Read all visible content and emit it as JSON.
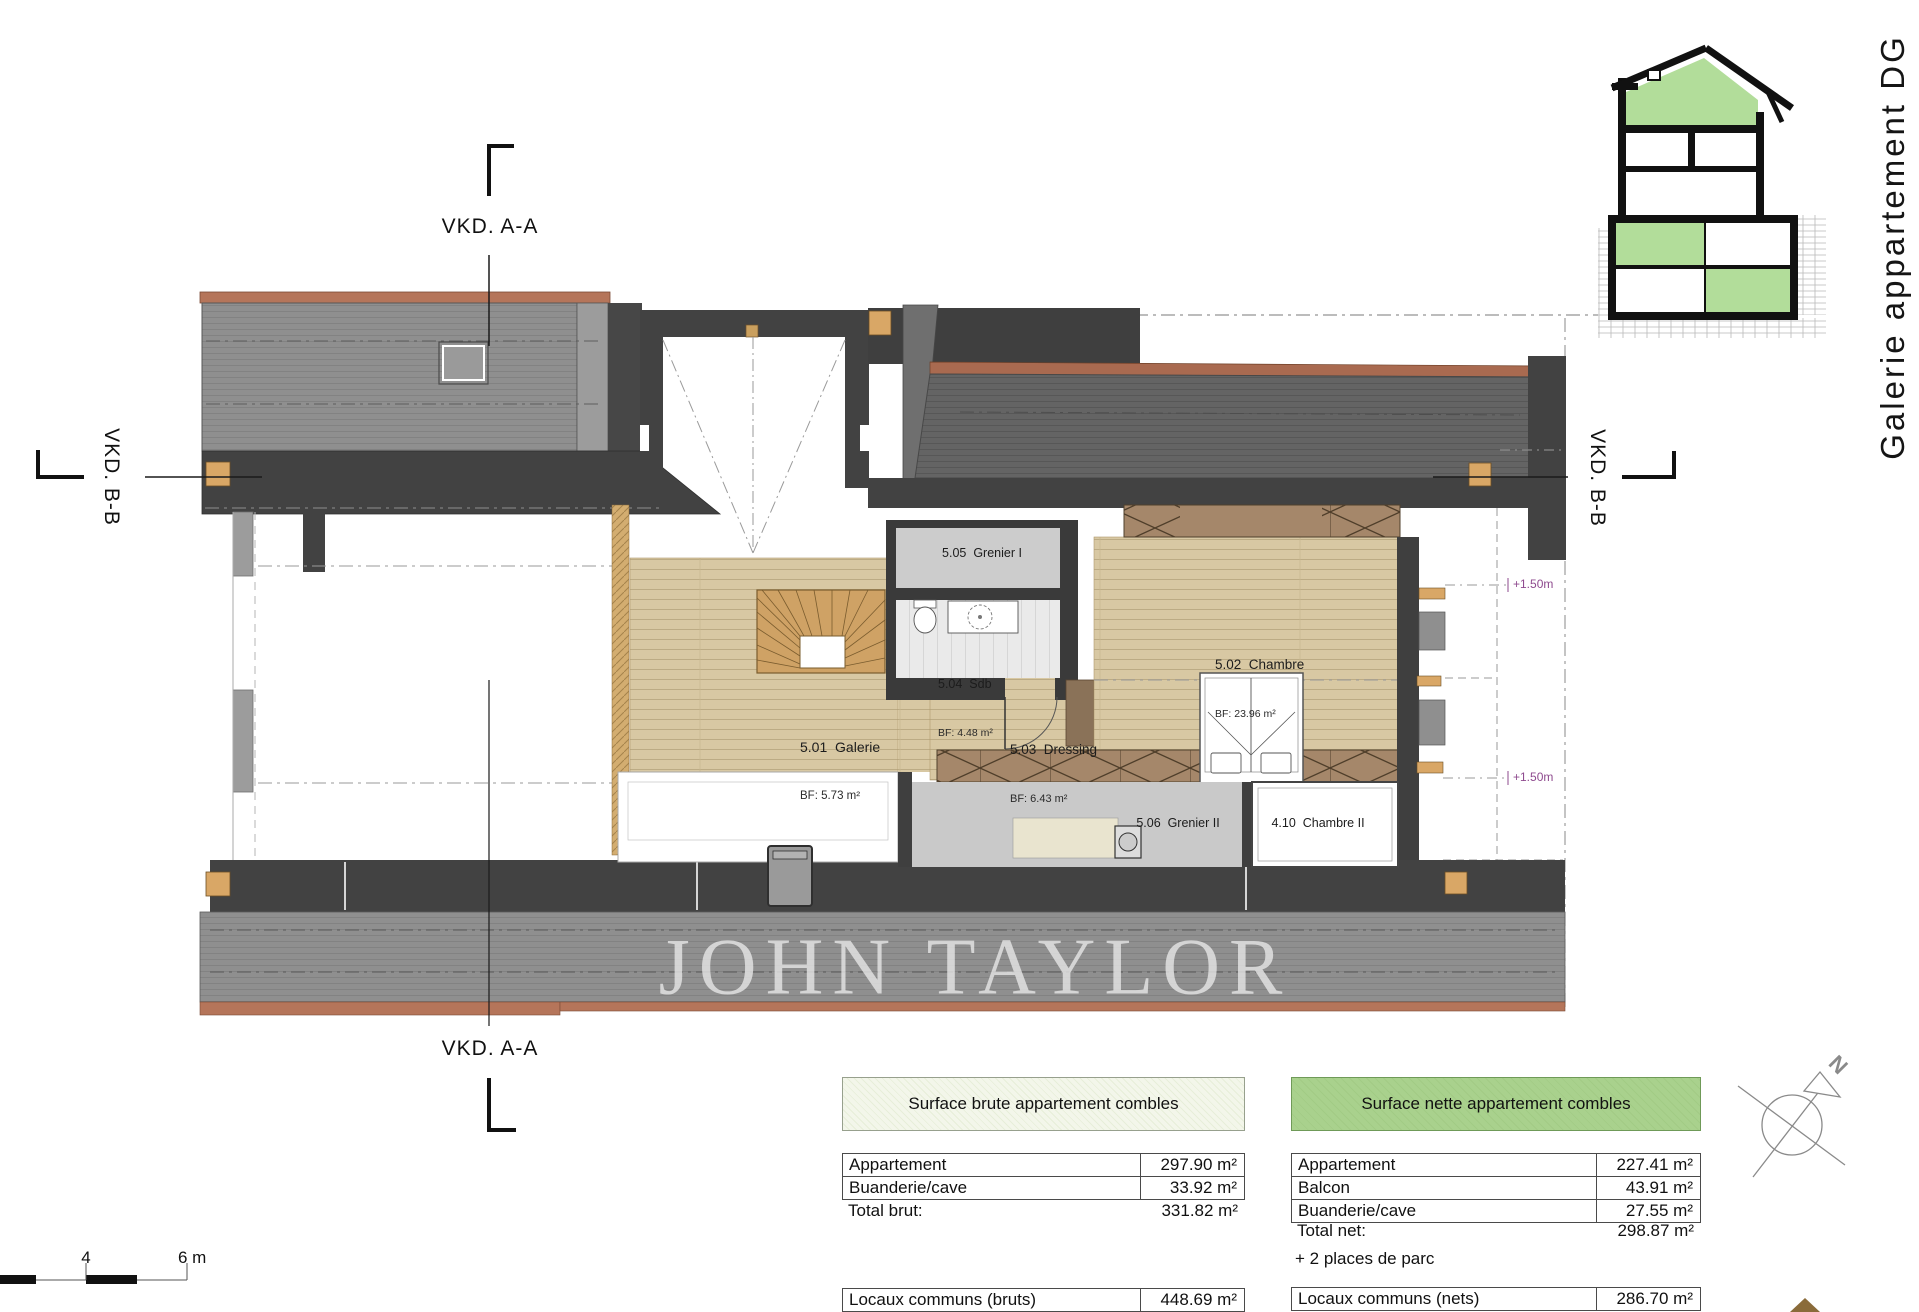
{
  "title": "Galerie appartement DG",
  "watermark": "JOHN TAYLOR",
  "sections": {
    "aa_top": "VKD. A-A",
    "aa_bottom": "VKD. A-A",
    "bb_left": "VKD. B-B",
    "bb_right": "VKD. B-B"
  },
  "levels": {
    "upper": "+1.50m",
    "lower": "+1.50m"
  },
  "north_label": "N",
  "scale_bar": {
    "tick_mid": "4",
    "tick_end": "6 m"
  },
  "rooms": {
    "grenier1": {
      "label": "5.05  Grenier I",
      "area": ""
    },
    "sdb": {
      "label": "5.04  Sdb",
      "area": "BF: 4.48 m²"
    },
    "chambre": {
      "label": "5.02  Chambre",
      "area": "BF: 23.96 m²"
    },
    "galerie": {
      "label": "5.01  Galerie",
      "area": "BF: 5.73 m²"
    },
    "dressing": {
      "label": "5.03  Dressing",
      "area": "BF: 6.43 m²"
    },
    "grenier2": {
      "label": "5.06  Grenier II",
      "area": ""
    },
    "chambre2": {
      "label": "4.10  Chambre II",
      "area": ""
    }
  },
  "tables": {
    "brute": {
      "header": "Surface brute appartement combles",
      "rows": [
        {
          "label": "Appartement",
          "value": "297.90 m²"
        },
        {
          "label": "Buanderie/cave",
          "value": "33.92 m²"
        }
      ],
      "total_label": "Total brut:",
      "total_value": "331.82 m²",
      "commons_label": "Locaux communs (bruts)",
      "commons_value": "448.69 m²"
    },
    "nette": {
      "header": "Surface nette appartement combles",
      "rows": [
        {
          "label": "Appartement",
          "value": "227.41 m²"
        },
        {
          "label": "Balcon",
          "value": "43.91 m²"
        },
        {
          "label": "Buanderie/cave",
          "value": "27.55 m²"
        }
      ],
      "total_label": "Total net:",
      "total_value": "298.87 m²",
      "note": "+ 2 places de parc",
      "commons_label": "Locaux communs (nets)",
      "commons_value": "286.70 m²"
    }
  },
  "colors": {
    "header_green": "#a9d18d",
    "header_light_green": "#eff4e6",
    "annotation_purple": "#8e4a8e",
    "wood_floor": "#d8c8a3",
    "roof_gray_light": "#8f8f8f",
    "roof_gray_dark": "#656565",
    "wall_dark": "#424242",
    "copper_edge": "#b5755a",
    "section_green": "#b2dd9a",
    "post_orange": "#d9a766"
  }
}
